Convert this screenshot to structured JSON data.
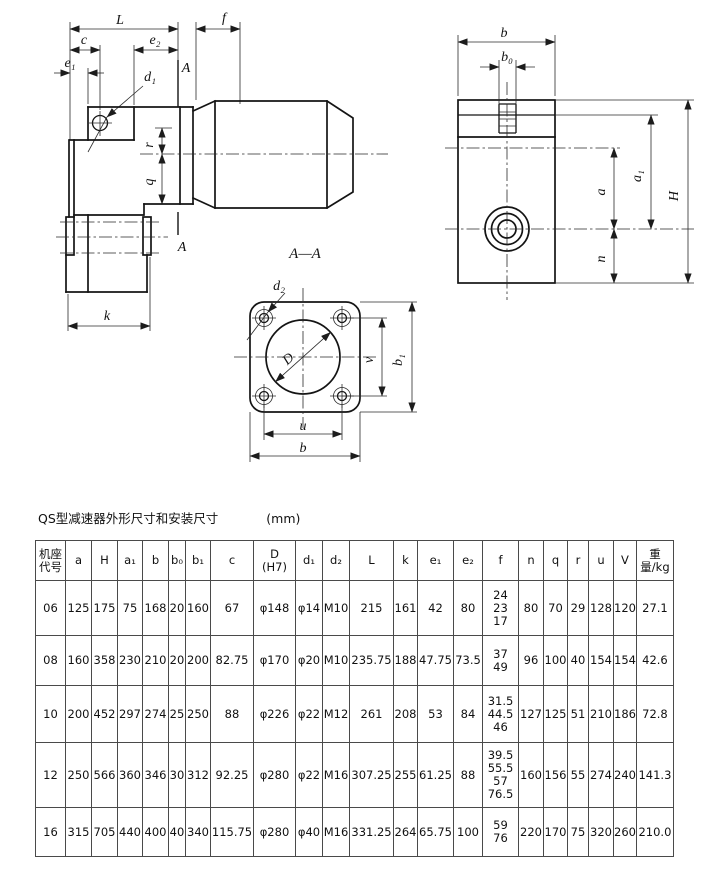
{
  "title": {
    "text": "QS型减速器外形尺寸和安装尺寸",
    "unit": "(mm)"
  },
  "drawing": {
    "front": {
      "L": "L",
      "f": "f",
      "c": "c",
      "e2": "e₂",
      "e1": "e₁",
      "d1": "d₁",
      "A_top": "A",
      "A_bot": "A",
      "r": "r",
      "q": "q",
      "k": "k"
    },
    "section": {
      "title": "A—A",
      "d2": "d₂",
      "D": "D",
      "v": "v",
      "b1": "b₁",
      "u": "u",
      "b": "b"
    },
    "right": {
      "b": "b",
      "b0": "b₀",
      "a": "a",
      "a1": "a₁",
      "H": "H",
      "n": "n"
    }
  },
  "table": {
    "headers": [
      "机座\n代号",
      "a",
      "H",
      "a₁",
      "b",
      "b₀",
      "b₁",
      "c",
      "D\n(H7)",
      "d₁",
      "d₂",
      "L",
      "k",
      "e₁",
      "e₂",
      "f",
      "n",
      "q",
      "r",
      "u",
      "V",
      "重量/kg"
    ],
    "rows": [
      [
        "06",
        "125",
        "175",
        "75",
        "168",
        "20",
        "160",
        "67",
        "φ148",
        "φ14",
        "M10",
        "215",
        "161",
        "42",
        "80",
        "24\n23\n17",
        "80",
        "70",
        "29",
        "128",
        "120",
        "27.1"
      ],
      [
        "08",
        "160",
        "358",
        "230",
        "210",
        "20",
        "200",
        "82.75",
        "φ170",
        "φ20",
        "M10",
        "235.75",
        "188",
        "47.75",
        "73.5",
        "37\n49",
        "96",
        "100",
        "40",
        "154",
        "154",
        "42.6"
      ],
      [
        "10",
        "200",
        "452",
        "297",
        "274",
        "25",
        "250",
        "88",
        "φ226",
        "φ22",
        "M12",
        "261",
        "208",
        "53",
        "84",
        "31.5\n44.5\n46",
        "127",
        "125",
        "51",
        "210",
        "186",
        "72.8"
      ],
      [
        "12",
        "250",
        "566",
        "360",
        "346",
        "30",
        "312",
        "92.25",
        "φ280",
        "φ22",
        "M16",
        "307.25",
        "255",
        "61.25",
        "88",
        "39.5\n55.5\n57\n76.5",
        "160",
        "156",
        "55",
        "274",
        "240",
        "141.3"
      ],
      [
        "16",
        "315",
        "705",
        "440",
        "400",
        "40",
        "340",
        "115.75",
        "φ280",
        "φ40",
        "M16",
        "331.25",
        "264",
        "65.75",
        "100",
        "59\n76",
        "220",
        "170",
        "75",
        "320",
        "260",
        "210.0"
      ]
    ]
  }
}
